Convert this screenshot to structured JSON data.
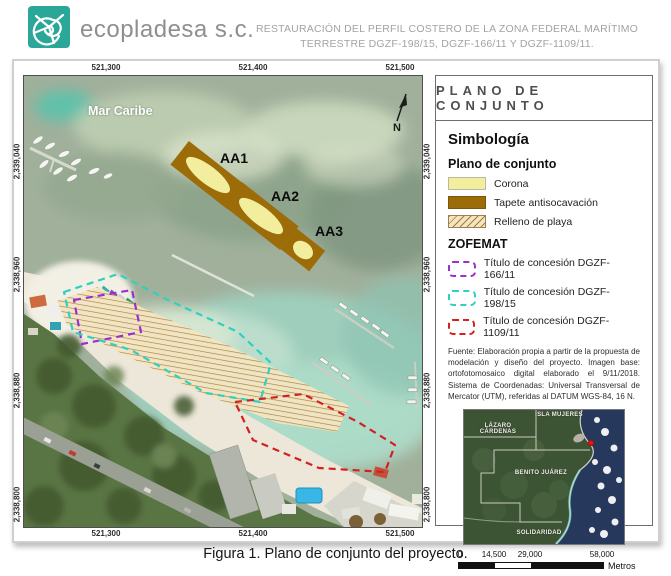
{
  "header": {
    "company": "ecopladesa s.c.",
    "project_title_line1": "RESTAURACIÓN DEL PERFIL COSTERO DE LA ZONA FEDERAL MARÍTIMO",
    "project_title_line2": "TERRESTRE DGZF-198/15, DGZF-166/11 Y DGZF-1109/11."
  },
  "map": {
    "sea_label": "Mar Caribe",
    "north_label": "N",
    "area_labels": [
      "AA1",
      "AA2",
      "AA3"
    ],
    "x_ticks": [
      "521,300",
      "521,400",
      "521,500"
    ],
    "y_ticks": [
      "2,339,040",
      "2,338,960",
      "2,338,880",
      "2,338,800"
    ]
  },
  "legend": {
    "panel_title": "PLANO DE CONJUNTO",
    "symbology_heading": "Simbología",
    "group_plano": {
      "heading": "Plano de conjunto",
      "items": [
        {
          "label": "Corona",
          "color": "#f2ee9e"
        },
        {
          "label": "Tapete antisocavación",
          "color": "#9c6c09"
        },
        {
          "label": "Relleno de playa",
          "color": "#a87c30"
        }
      ]
    },
    "group_zofemat": {
      "heading": "ZOFEMAT",
      "items": [
        {
          "label": "Título de concesión DGZF-166/11",
          "color": "#9a2fd0"
        },
        {
          "label": "Título de concesión DGZF-198/15",
          "color": "#2fd0c0"
        },
        {
          "label": "Título de concesión DGZF-1109/11",
          "color": "#d42020"
        }
      ]
    },
    "source_note": "Fuente: Elaboración propia a partir de la propuesta de modelación y diseño del proyecto. Imagen base: ortofotomosaico digital elaborado el 9/11/2018. Sistema de Coordenadas: Universal Transversal de Mercator (UTM), referidas al DATUM WGS-84, 16 N.",
    "inset_labels": [
      "ISLA MUJERES",
      "LÁZARO CÁRDENAS",
      "BENITO JUÁREZ",
      "SOLIDARIDAD"
    ],
    "scale_bar": {
      "ticks": [
        "0",
        "14,500",
        "29,000",
        "58,000"
      ],
      "unit": "Metros"
    }
  },
  "caption": "Figura 1. Plano de conjunto del proyecto."
}
